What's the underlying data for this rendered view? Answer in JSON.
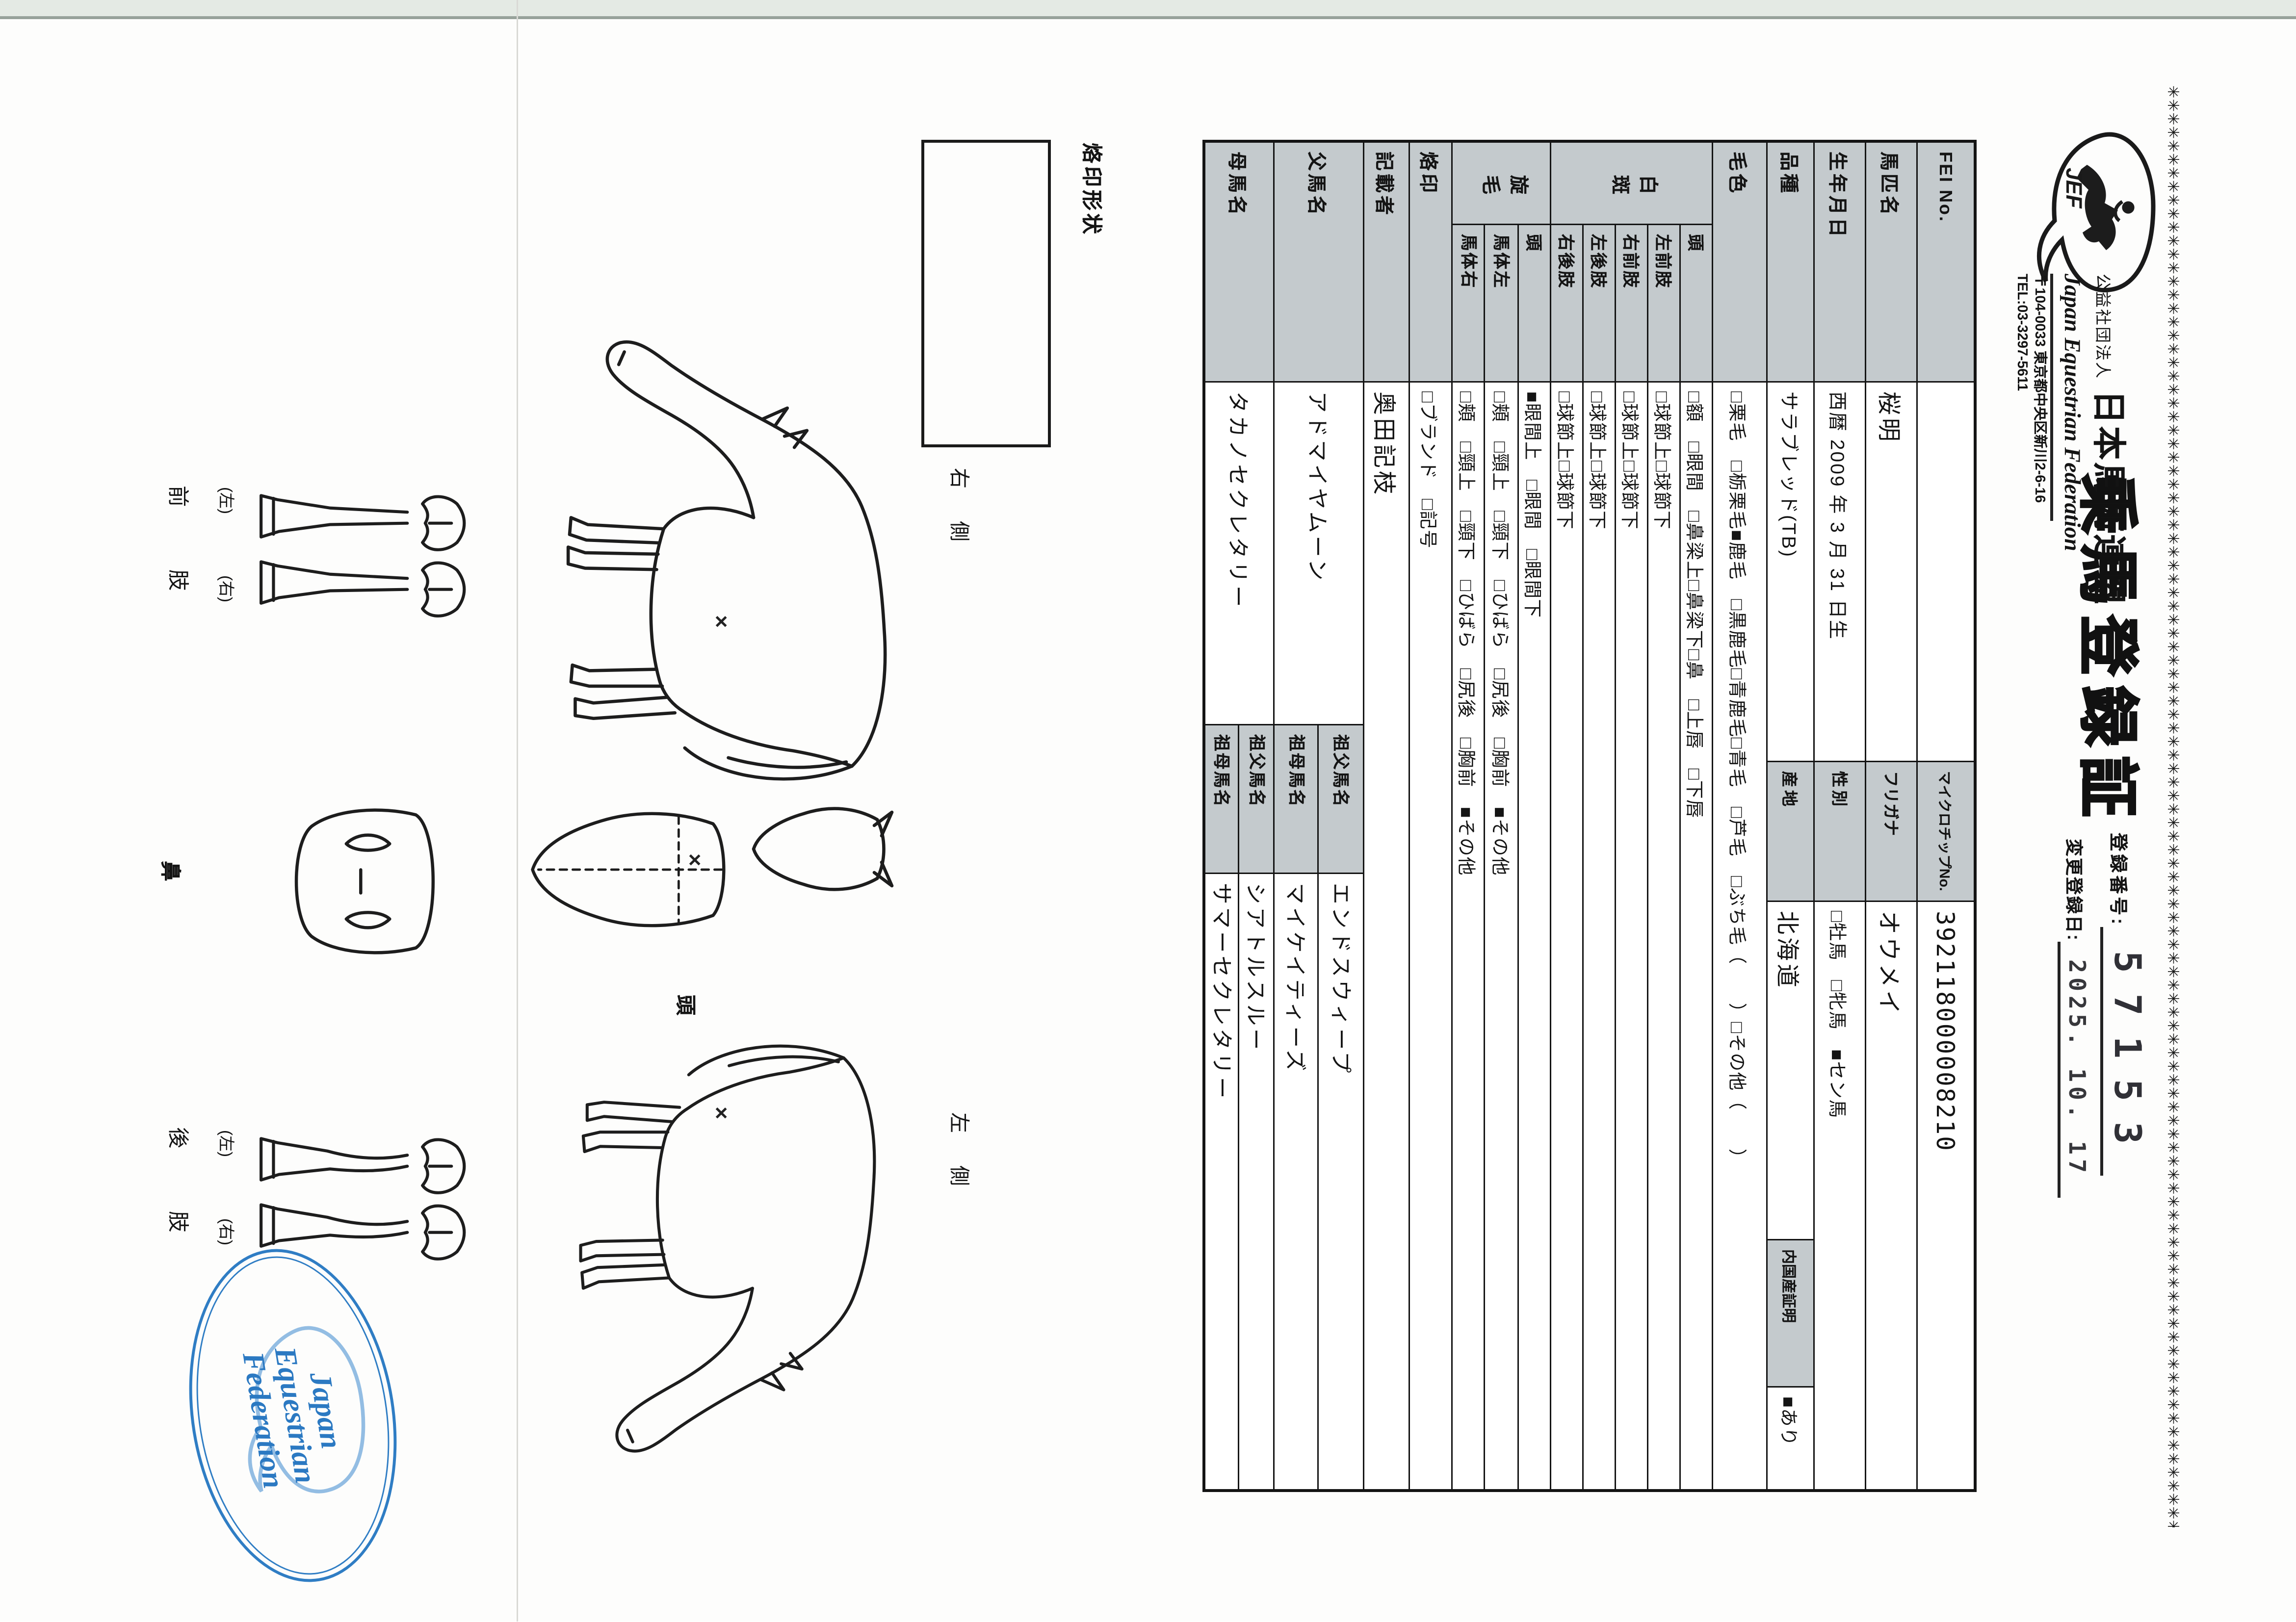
{
  "decor": {
    "asterisk_row": "✳✳✳✳✳✳✳✳✳✳✳✳✳✳✳✳✳✳✳✳✳✳✳✳✳✳✳✳✳✳✳✳✳✳✳✳✳✳✳✳✳✳✳✳✳✳✳✳✳✳✳✳✳✳✳✳✳✳✳✳✳✳✳✳✳✳✳✳✳✳✳✳✳✳✳✳✳✳✳✳✳✳✳✳✳✳✳✳✳✳✳✳✳✳✳✳✳✳✳✳✳✳✳✳✳✳✳✳✳✳✳✳"
  },
  "header": {
    "logo_text": "JEF",
    "org_type": "公益社団法人",
    "org_name_jp": "日本馬術連盟",
    "org_name_en": "Japan Equestrian Federation",
    "address": "〒104-0033 東京都中央区新川2-6-16",
    "tel": "TEL:03-3297-5611",
    "title": "乗馬登録証",
    "reg_no_label": "登録番号:",
    "reg_no": "57153",
    "change_date_label": "変更登録日:",
    "change_date": "2025. 10. 17"
  },
  "table": {
    "fei_label": "FEI No.",
    "fei_value": "",
    "microchip_label": "マイクロチップNo.",
    "microchip_value": "392118000008210",
    "name_label": "馬匹名",
    "name_value": "桜明",
    "furigana_label": "フリガナ",
    "furigana_value": "オウメイ",
    "birth_label": "生年月日",
    "birth_value": "西暦 2009 年 3 月 31 日生",
    "sex_label": "性別",
    "sex_value": "□牡馬　□牝馬　■セン馬",
    "breed_label": "品種",
    "breed_value": "サラブレッド(TB)",
    "origin_label": "産地",
    "origin_value": "北海道",
    "domestic_label": "内国産証明",
    "domestic_value": "■あり",
    "coat_label": "毛色",
    "coat_value": "□栗毛　□栃栗毛■鹿毛　□黒鹿毛□青鹿毛□青毛　□芦毛　□ぶち毛（　　）□その他（　　）",
    "hakuhan_label": "白斑",
    "hakuhan_head_label": "頭",
    "hakuhan_head_value": "□額　□眼間　□鼻梁上□鼻梁下□鼻　□上唇　□下唇",
    "lf_label": "左前肢",
    "rf_label": "右前肢",
    "lh_label": "左後肢",
    "rh_label": "右後肢",
    "fetlock_value": "□球節上□球節下",
    "senmo_label": "旋毛",
    "senmo_head_label": "頭",
    "senmo_head_value": "■眼間上　□眼間　□眼間下",
    "body_left_label": "馬体左",
    "body_right_label": "馬体右",
    "body_whorl_value": "□頬　□頸上　□頸下　□ひばら　□尻後　□胸前　■その他",
    "brand_label": "烙印",
    "brand_value": "□ブランド　□記号",
    "recorder_label": "記載者",
    "recorder_value": "奥田記枝",
    "sire_label": "父馬名",
    "sire_value": "アドマイヤムーン",
    "sire_gf_label": "祖父馬名",
    "sire_gf_value": "エンドスウィープ",
    "sire_gm_label": "祖母馬名",
    "sire_gm_value": "マイケイティーズ",
    "dam_label": "母馬名",
    "dam_value": "タカノセクレタリー",
    "dam_gf_label": "祖父馬名",
    "dam_gf_value": "シアトルスルー",
    "dam_gm_label": "祖母馬名",
    "dam_gm_value": "サマーセクレタリー"
  },
  "diagram": {
    "branding_label": "烙印形状",
    "right_side_label": "右　側",
    "left_side_label": "左　側",
    "head_label": "頭",
    "nose_label": "鼻",
    "front_limb_label": "前　肢",
    "hind_limb_label": "後　肢",
    "left_paren": "(左)",
    "right_paren": "(右)",
    "whorl_mark": "×"
  },
  "stamp": {
    "line1": "Japan",
    "line2": "Equestrian",
    "line3": "Federation",
    "color": "#2b79c2"
  }
}
